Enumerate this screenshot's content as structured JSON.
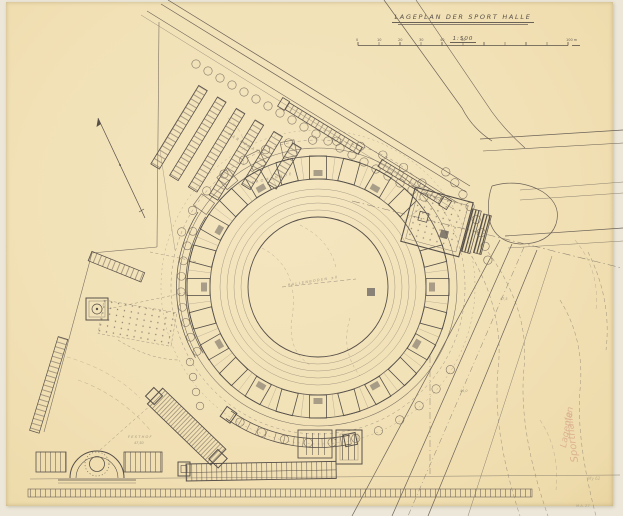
{
  "title_block": {
    "title": "LAGEPLAN DER SPORT HALLE",
    "scale": "1:500",
    "scale_bar_ticks": [
      "0",
      "10",
      "20",
      "30",
      "40",
      "50",
      "100"
    ],
    "scale_bar_unit": "m"
  },
  "plan_labels": {
    "parking": "PARKPLATZ",
    "promenade": "PROMENADE",
    "arena_floor": "HALLENBODEN ±0",
    "festhof": "FESTHOF",
    "festhof_elevation": "47,50",
    "elevation_a": "47,5",
    "elevation_b": "46,0"
  },
  "handwritten_notes": {
    "red_vertical_1": "Sporthalle",
    "red_vertical_2": "Lageplan",
    "pencil_small_1": "My 62",
    "pencil_small_2": "M.A. 27"
  },
  "colors": {
    "paper": "#f2e1b6",
    "paper_edge": "#ece7d8",
    "ink": "#57504a",
    "ink_faint": "#8b8070",
    "red_pencil": "#c98a74"
  }
}
